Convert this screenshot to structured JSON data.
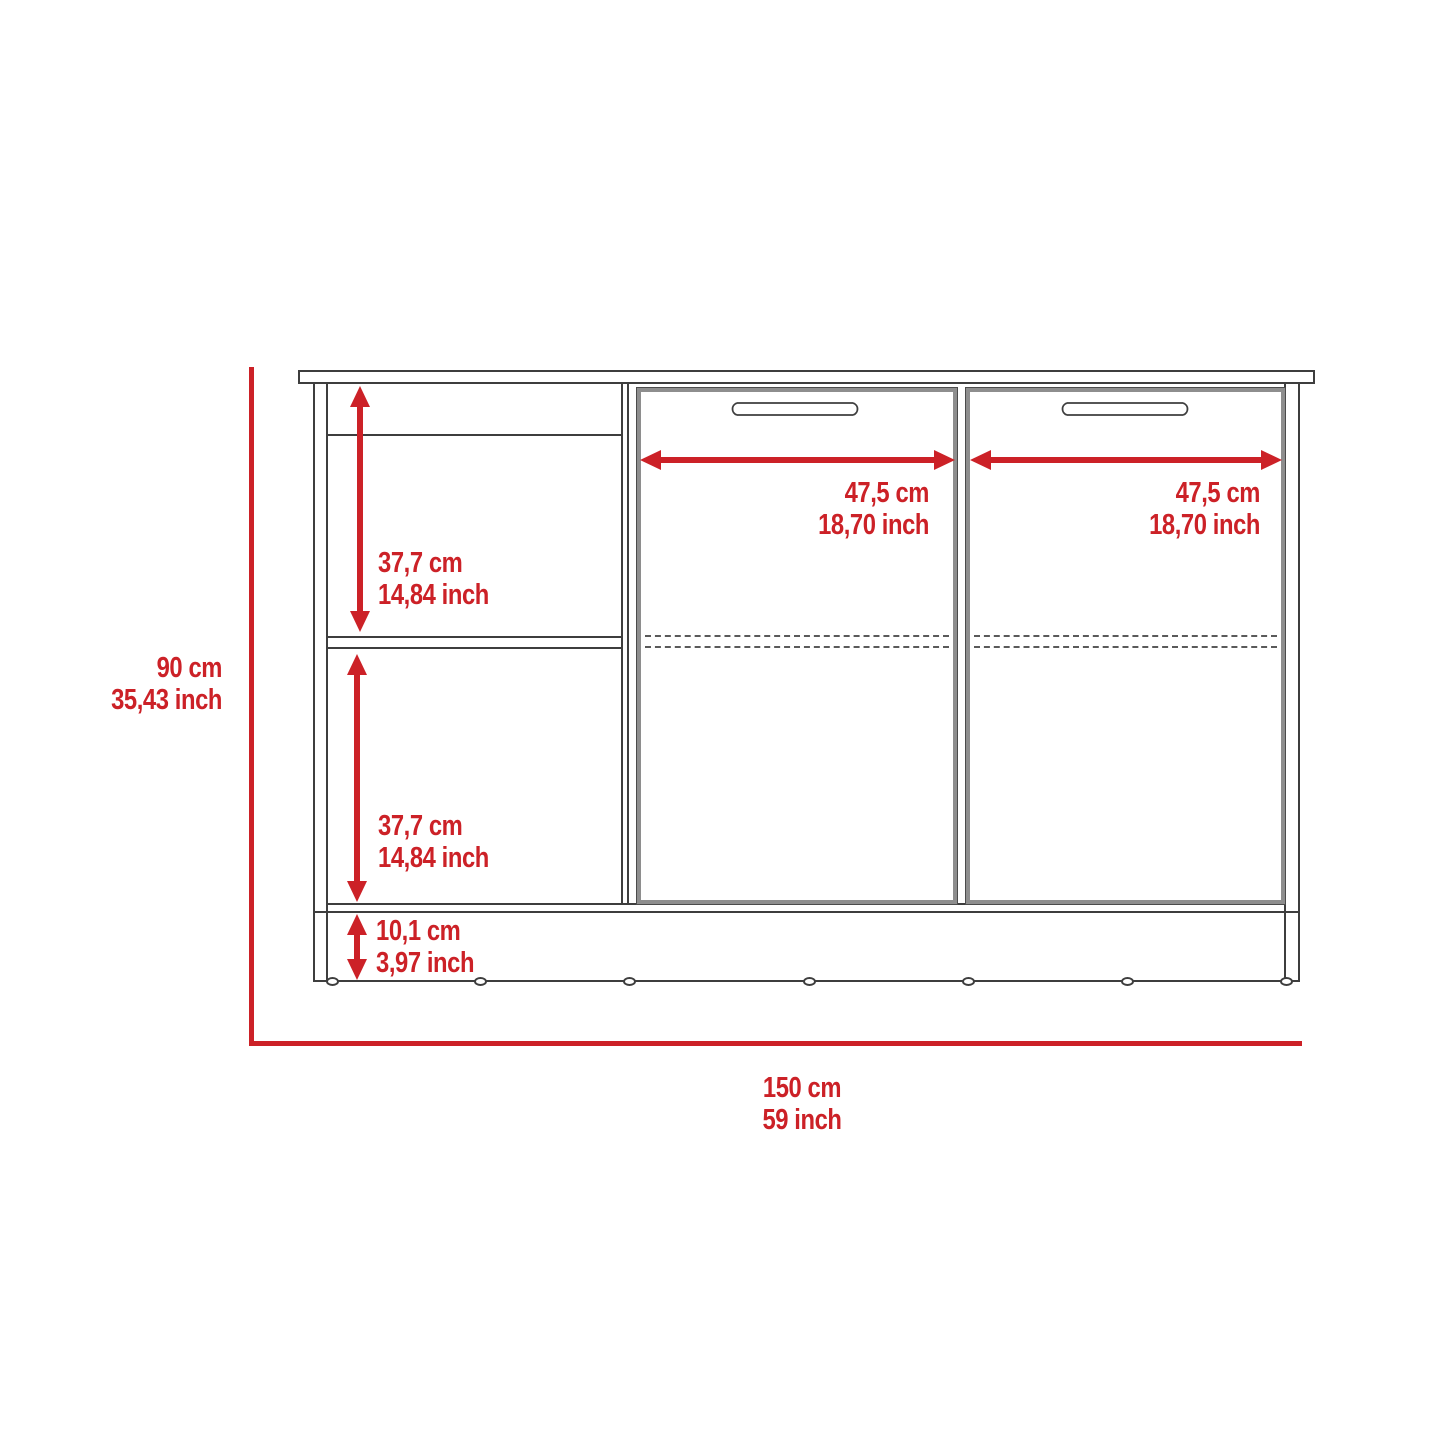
{
  "figure": {
    "type": "furniture-dimension-diagram",
    "subject": "sideboard cabinet front view with open side shelves and two doors",
    "colors": {
      "dimension_red": "#cc2127",
      "outline_dark": "#3e3e3e",
      "door_edge_gray": "#8e8e8e"
    },
    "dims": {
      "height": {
        "cm": "90 cm",
        "inch": "35,43 inch"
      },
      "upper_shelf": {
        "cm": "37,7 cm",
        "inch": "14,84 inch"
      },
      "lower_shelf": {
        "cm": "37,7 cm",
        "inch": "14,84 inch"
      },
      "base": {
        "cm": "10,1 cm",
        "inch": "3,97 inch"
      },
      "left_door_width": {
        "cm": "47,5 cm",
        "inch": "18,70 inch"
      },
      "right_door_width": {
        "cm": "47,5 cm",
        "inch": "18,70 inch"
      },
      "total_width": {
        "cm": "150 cm",
        "inch": "59 inch"
      }
    }
  }
}
